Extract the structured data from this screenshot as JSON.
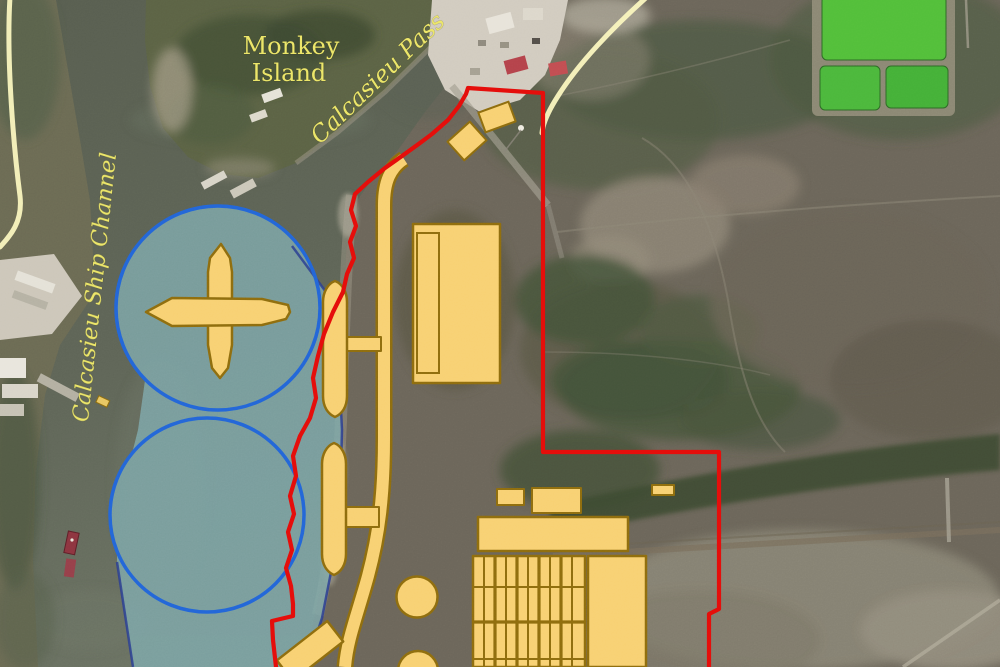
{
  "labels": {
    "island_line1": "Monkey",
    "island_line2": "Island",
    "pass": "Calcasieu Pass",
    "channel": "Calcasieu Ship Channel"
  },
  "theme": {
    "label-yellow": "#ece66a",
    "boundary-red": "#e50d0a",
    "basin-blue": "#2366d8",
    "dredge-teal": "#7fa9ab",
    "dredge-edge": "#2c3e92",
    "facility-fill": "#f8d173",
    "facility-stroke": "#8f6d0e",
    "road-yellow": "#faf5be"
  }
}
